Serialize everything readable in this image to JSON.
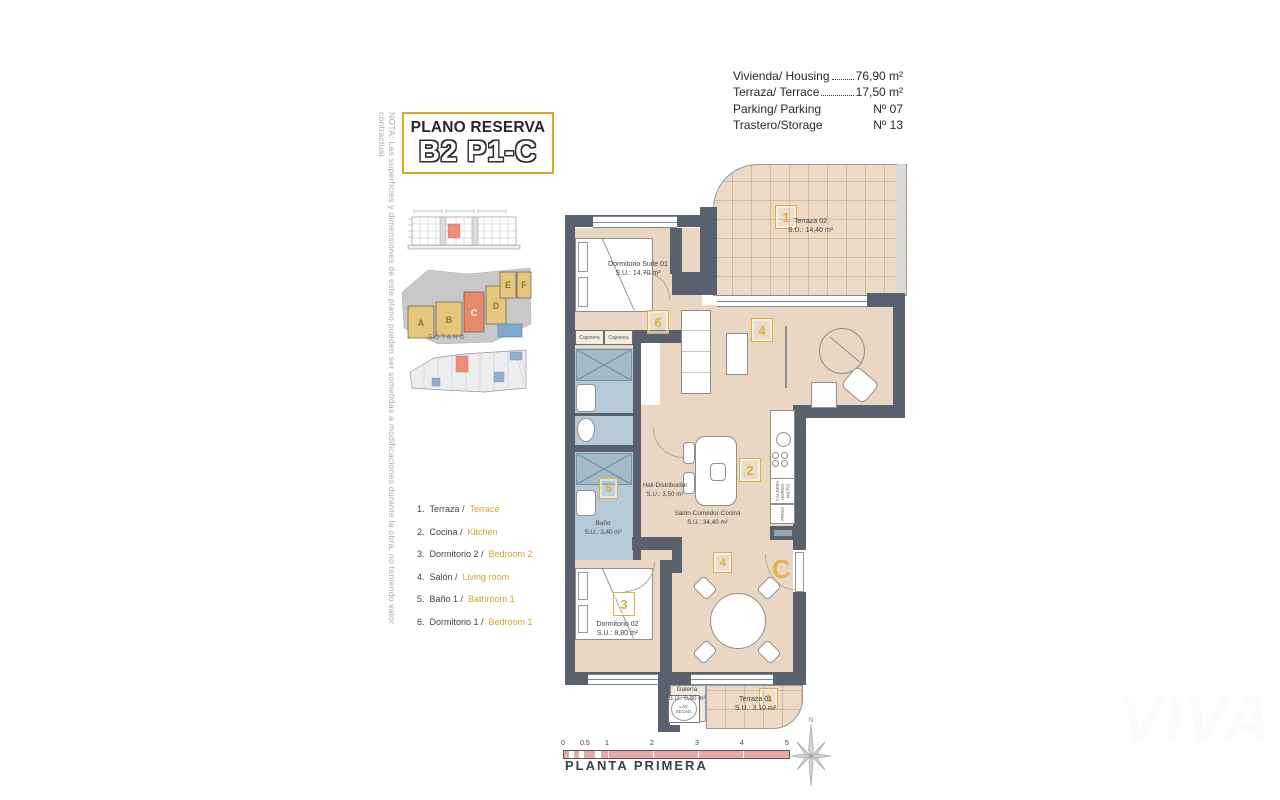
{
  "colors": {
    "accent_yellow": "#d9a826",
    "wall_gray": "#59616e",
    "floor_beige": "#e9d7c4",
    "bath_blue": "#b7c9d6",
    "highlight_orange": "#e8896a",
    "scale_pink": "#e9aaa5"
  },
  "note": "NOTA: Las superficies y dimensiones de este plano pueden ser sometidas a modificaciones durante la obra, no teniendo valor contractual.",
  "title": {
    "kicker": "PLANO RESERVA",
    "code": "B2 P1-C"
  },
  "info": {
    "rows": [
      {
        "label": "Vivienda/ Housing",
        "value": "76,90 m²"
      },
      {
        "label": "Terraza/ Terrace",
        "value": "17,50 m²"
      },
      {
        "label": "Parking/ Parking",
        "value": "Nº 07"
      },
      {
        "label": "Trastero/Storage",
        "value": "Nº 13"
      }
    ]
  },
  "site": {
    "sotano_label": "SÓTANO",
    "letters": [
      "A",
      "B",
      "C",
      "D",
      "E",
      "F"
    ]
  },
  "legend": {
    "items": [
      {
        "n": "1.",
        "es": "Terraza /",
        "en": "Terrace"
      },
      {
        "n": "2.",
        "es": "Cocina /",
        "en": "Kitchen"
      },
      {
        "n": "3.",
        "es": "Dormitorio 2 /",
        "en": "Bedroom 2"
      },
      {
        "n": "4.",
        "es": "Salón /",
        "en": "Living room"
      },
      {
        "n": "5.",
        "es": "Baño 1 /",
        "en": "Bathroom 1"
      },
      {
        "n": "6.",
        "es": "Dormitorio 1 /",
        "en": "Bedroom 1"
      }
    ]
  },
  "plan": {
    "terraza02": {
      "name": "Terraza 02",
      "area": "S.U.: 14,40 m²",
      "badge": "1"
    },
    "suite": {
      "name": "Dormitorio Suite 01",
      "area": "S.U.: 14,70 m²",
      "badge": "6"
    },
    "salon": {
      "name": "Salón-Comedor-Cocina",
      "area": "S.U.: 34,40 m²",
      "badge_living": "4",
      "badge_dining": "4",
      "badge_kitchen": "2"
    },
    "hall": {
      "name": "Hall-Distribuidor",
      "area": "S.U.: 3,50 m²"
    },
    "bano": {
      "name": "Baño",
      "area": "S.U.: 3,40 m²",
      "badge": "5"
    },
    "dorm02": {
      "name": "Dormitorio 02",
      "area": "S.U.: 8,80 m²",
      "badge": "3"
    },
    "galeria": {
      "name": "Galería",
      "area": "S.U.: 0,80 m²"
    },
    "terraza01": {
      "name": "Terraza 01",
      "area": "S.U.: 3,10 m²",
      "badge": "1"
    },
    "entrance": "C",
    "cajonera": "Cajonera",
    "lav1": "LAV.",
    "lav2": "SECAD.",
    "kitchen1": "CALDERA",
    "kitchen2": "HORNO-MICRO",
    "kitchen3": "FRIGO"
  },
  "footer": {
    "scale_labels": [
      "0",
      "0.5",
      "1",
      "2",
      "3",
      "4",
      "5"
    ],
    "caption": "PLANTA PRIMERA",
    "north": "N"
  },
  "watermark": "VIVA"
}
